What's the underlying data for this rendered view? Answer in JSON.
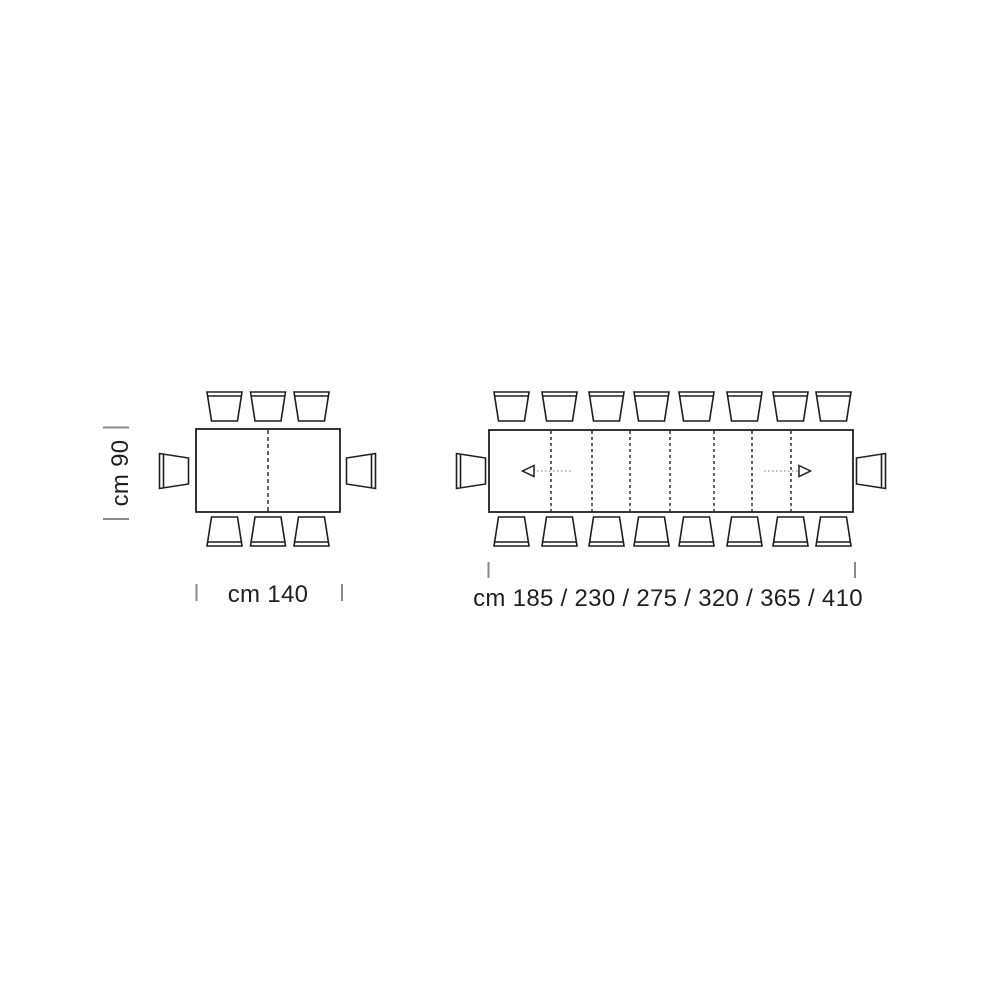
{
  "colors": {
    "background": "#ffffff",
    "line": "#1f1f1f",
    "tick": "#8a8a8a",
    "arrow_shaft": "#9a9a9a",
    "text": "#1f1f1f"
  },
  "fixed_table": {
    "depth_dimension": "cm 90",
    "width_dimension": "cm 140",
    "seats": {
      "top": 3,
      "bottom": 3,
      "left": 1,
      "right": 1,
      "total": 8
    }
  },
  "extending_table": {
    "width_dimension": "cm 185 / 230 / 275 / 320 / 365 / 410",
    "extension_lengths_cm": [
      185,
      230,
      275,
      320,
      365,
      410
    ],
    "leaf_division_lines": 7,
    "extension_arrows": [
      "left",
      "right"
    ],
    "seats": {
      "top": 8,
      "bottom": 8,
      "left": 1,
      "right": 1,
      "total": 18
    }
  }
}
